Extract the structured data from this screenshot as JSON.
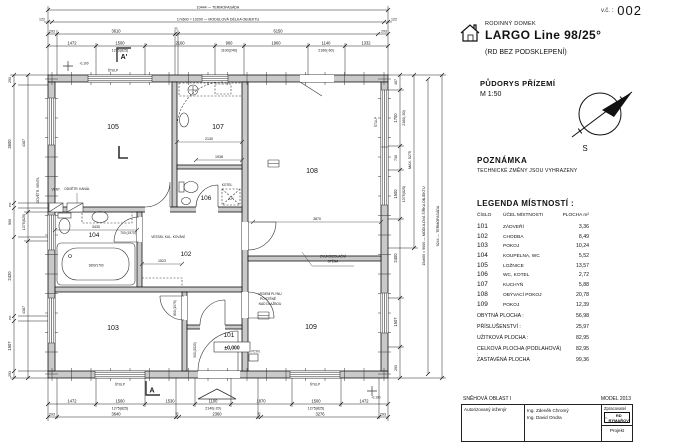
{
  "sheet": {
    "number_label": "v.č. :",
    "number": "002"
  },
  "header": {
    "category": "RODINNÝ DOMEK",
    "title": "LARGO Line 98/25°",
    "subtitle": "(RD BEZ PODSKLEPENÍ)",
    "drawing": "PŮDORYS PŘÍZEMÍ",
    "scale": "M 1:50",
    "north": "S"
  },
  "note": {
    "title": "POZNÁMKA",
    "body": "TECHNICKÉ ZMĚNY JSOU VYHRAZENY"
  },
  "legend": {
    "title": "LEGENDA MÍSTNOSTÍ :",
    "columns": {
      "number": "ČÍSLO",
      "purpose": "ÚČEL MÍSTNOSTI",
      "area": "PLOCHA m²"
    },
    "rooms": [
      {
        "number": "101",
        "purpose": "ZÁDVEŘÍ",
        "area": "3,36"
      },
      {
        "number": "102",
        "purpose": "CHODBA",
        "area": "8,49"
      },
      {
        "number": "103",
        "purpose": "POKOJ",
        "area": "10,24"
      },
      {
        "number": "104",
        "purpose": "KOUPELNA, WC",
        "area": "5,52"
      },
      {
        "number": "105",
        "purpose": "LOŽNICE",
        "area": "13,57"
      },
      {
        "number": "106",
        "purpose": "WC, KOTEL",
        "area": "2,72"
      },
      {
        "number": "107",
        "purpose": "KUCHYŇ",
        "area": "5,88"
      },
      {
        "number": "108",
        "purpose": "OBÝVACÍ POKOJ",
        "area": "20,78"
      },
      {
        "number": "109",
        "purpose": "POKOJ",
        "area": "12,39"
      }
    ],
    "totals": [
      {
        "label": "OBYTNÁ PLOCHA :",
        "value": "56,98"
      },
      {
        "label": "PŘÍSLUŠENSTVÍ :",
        "value": "25,97"
      },
      {
        "label": "UŽITKOVÁ PLOCHA :",
        "value": "82,95"
      },
      {
        "label": "CELKOVÁ PLOCHA (PODLAHOVÁ) :",
        "value": "82,95"
      },
      {
        "label": "ZASTAVĚNÁ PLOCHA",
        "value": "99,36"
      }
    ]
  },
  "titleblock": {
    "snow_area": "SNĚHOVÁ OBLAST I",
    "model": "MODEL 2013",
    "engineer_label": "Autorizovaný inženýr",
    "engineer_1": "Ing. Zdeněk Chromý",
    "engineer_2": "Ing. David Ondra",
    "producer_label": "Zpracovatel",
    "producer_name": "RD RÝMAŘOV",
    "project_label": "Projekt"
  },
  "plan": {
    "rooms": {
      "r101": "101",
      "r102": "102",
      "r103": "103",
      "r104": "104",
      "r105": "105",
      "r106": "106",
      "r107": "107",
      "r108": "108",
      "r109": "109"
    },
    "level_main": "±0,000",
    "level_grade": "-0,100",
    "section": {
      "top": "A'",
      "bottom": "A"
    },
    "labels": {
      "stulp": "ŠTULP",
      "vent": "VENT.",
      "kanal": "ODVĚTR. KANÁL",
      "zvuk1": "ZVUKOIZOLAČNÍ",
      "zvuk2": "STĚNA",
      "plyn": "PLYN.",
      "vedeni1": "VEDENÍ PLYNU",
      "vedeni2": "PO STĚNĚ",
      "vedeni3": "NAD DLAŽBOU",
      "kovani": "VESTAV. KUL. KOVÁNÍ",
      "kotel": "KOTEL",
      "ap": "A.P.",
      "tub": "1800/1700",
      "ventil": "ODVĚTR. VENTIL"
    },
    "dims": {
      "top1": "10444 — TERMOFASÁDA",
      "top2": [
        "122",
        "17x600 = 10200 — MODULOVÁ DÉLKA OBJEKTU",
        "122"
      ],
      "top3": [
        "293",
        "3610",
        "95",
        "6150",
        "293"
      ],
      "top4": [
        "1472",
        "1500",
        "1275(825)",
        "2160",
        "900",
        "1100(240)",
        "1960",
        "1140",
        "2160(-60)",
        "1332"
      ],
      "bottom1": [
        "1472",
        "1500",
        "1275(825)",
        "1530",
        "1100",
        "2140(-20)",
        "1870",
        "1500",
        "1275(825)",
        "1472"
      ],
      "bottom2": [
        "293",
        "3640",
        "95",
        "2360",
        "95",
        "3276",
        "293"
      ],
      "left1": [
        "293",
        "3600",
        "150",
        "900",
        "2420",
        "150",
        "1507",
        "293"
      ],
      "left2": [
        "4387",
        "1375(825)",
        "4387"
      ],
      "right1": [
        "467",
        "1700",
        "2160(-50)",
        "730",
        "1500",
        "1375(825)",
        "2400",
        "1507",
        "293"
      ],
      "right2": "MAX. 5275",
      "right3": "15x600 = 9000 — MODULOVÁ ŠÍŘKA OBJEKTU",
      "right4": "9244 — TERMOFASÁDA",
      "inner": {
        "d3870": "3870",
        "d2130": "2130",
        "d1938": "1938",
        "d3430": "3430",
        "d1523": "1523",
        "door1": "800 (1970)",
        "door2": "900 (2020)",
        "door3": "700 (1970)"
      }
    }
  }
}
